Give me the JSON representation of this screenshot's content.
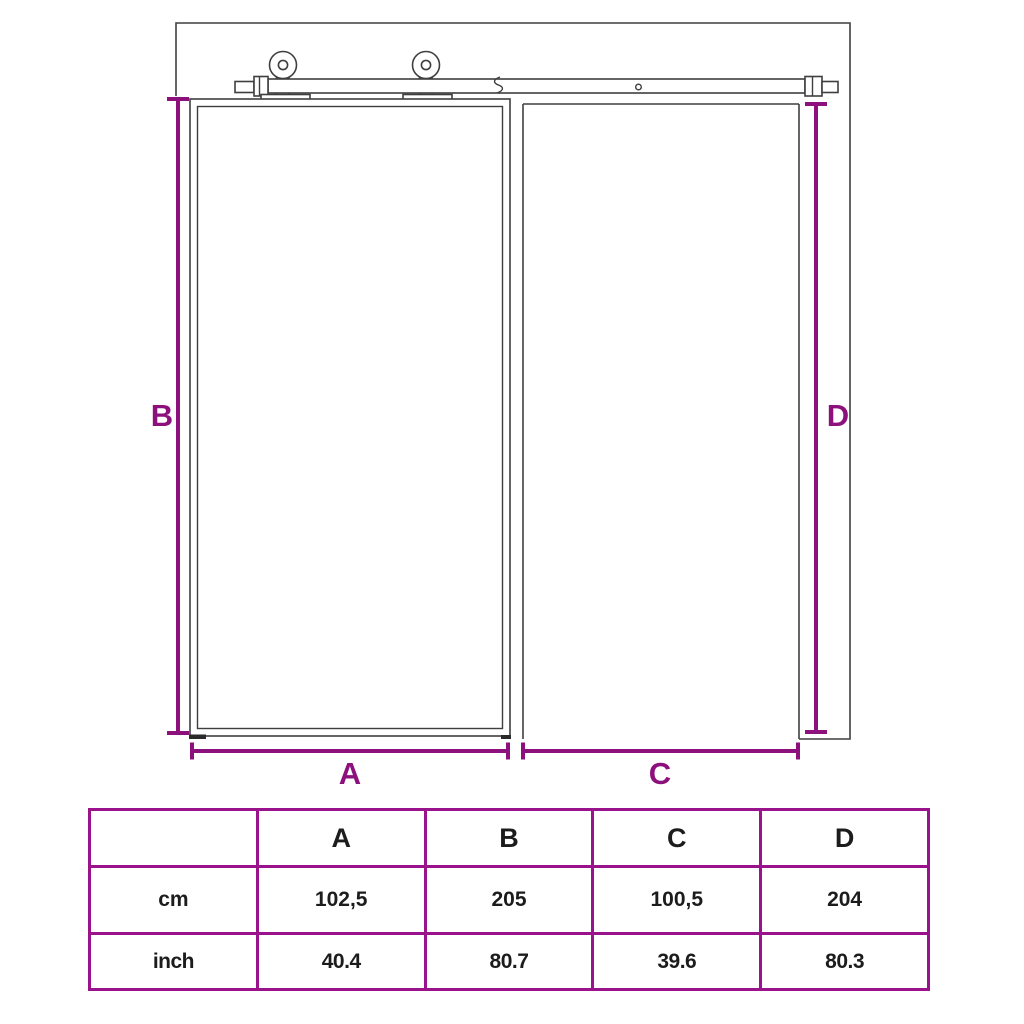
{
  "colors": {
    "accent_purple": "#8c117c",
    "table_border": "#9a128c",
    "line_gray": "#3f3f3f"
  },
  "diagram": {
    "labels": {
      "a": "A",
      "b": "B",
      "c": "C",
      "d": "D"
    }
  },
  "table": {
    "header": [
      "",
      "A",
      "B",
      "C",
      "D"
    ],
    "rows": [
      {
        "label": "cm",
        "values": [
          "102,5",
          "205",
          "100,5",
          "204"
        ]
      },
      {
        "label": "inch",
        "values": [
          "40.4",
          "80.7",
          "39.6",
          "80.3"
        ]
      }
    ]
  }
}
